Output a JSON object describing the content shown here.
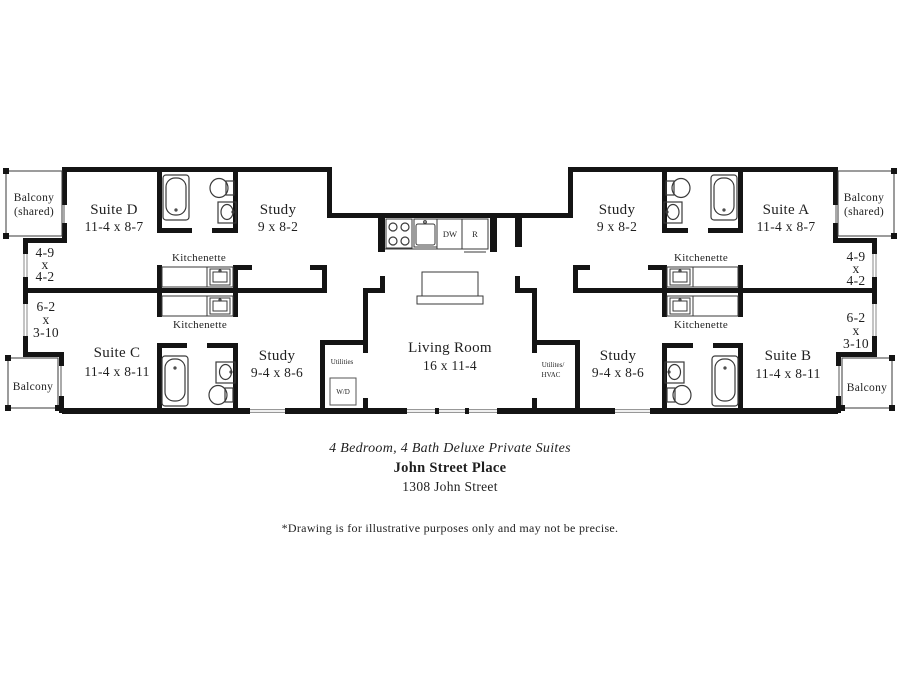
{
  "plan": {
    "suites": {
      "d": {
        "name": "Suite D",
        "dims": "11-4 x 8-7"
      },
      "a": {
        "name": "Suite A",
        "dims": "11-4 x 8-7"
      },
      "c": {
        "name": "Suite C",
        "dims": "11-4 x 8-11"
      },
      "b": {
        "name": "Suite B",
        "dims": "11-4 x 8-11"
      }
    },
    "study_upper": {
      "name": "Study",
      "dims": "9 x 8-2"
    },
    "study_lower": {
      "name": "Study",
      "dims": "9-4 x 8-6"
    },
    "living_room": {
      "name": "Living Room",
      "dims": "16 x 11-4"
    },
    "kitchenette_label": "Kitchenette",
    "balcony_shared": {
      "line1": "Balcony",
      "line2": "(shared)"
    },
    "balcony_label": "Balcony",
    "closet_upper": {
      "line1": "4-9",
      "line2": "x",
      "line3": "4-2"
    },
    "closet_lower": {
      "line1": "6-2",
      "line2": "x",
      "line3": "3-10"
    },
    "utilities_label": "Utilities",
    "washer_dryer_label": "W/D",
    "utilities_hvac": {
      "line1": "Utilites/",
      "line2": "HVAC"
    },
    "appliances": {
      "dishwasher": "DW",
      "refrigerator": "R"
    }
  },
  "footer": {
    "tagline": "4 Bedroom, 4 Bath Deluxe Private Suites",
    "property_name": "John Street Place",
    "address": "1308 John Street",
    "disclaimer": "*Drawing is for illustrative purposes only and may not be precise."
  },
  "colors": {
    "wall": "#141414",
    "fixture_line": "#3a3a3a",
    "text": "#1f1f1f",
    "background": "#ffffff"
  }
}
